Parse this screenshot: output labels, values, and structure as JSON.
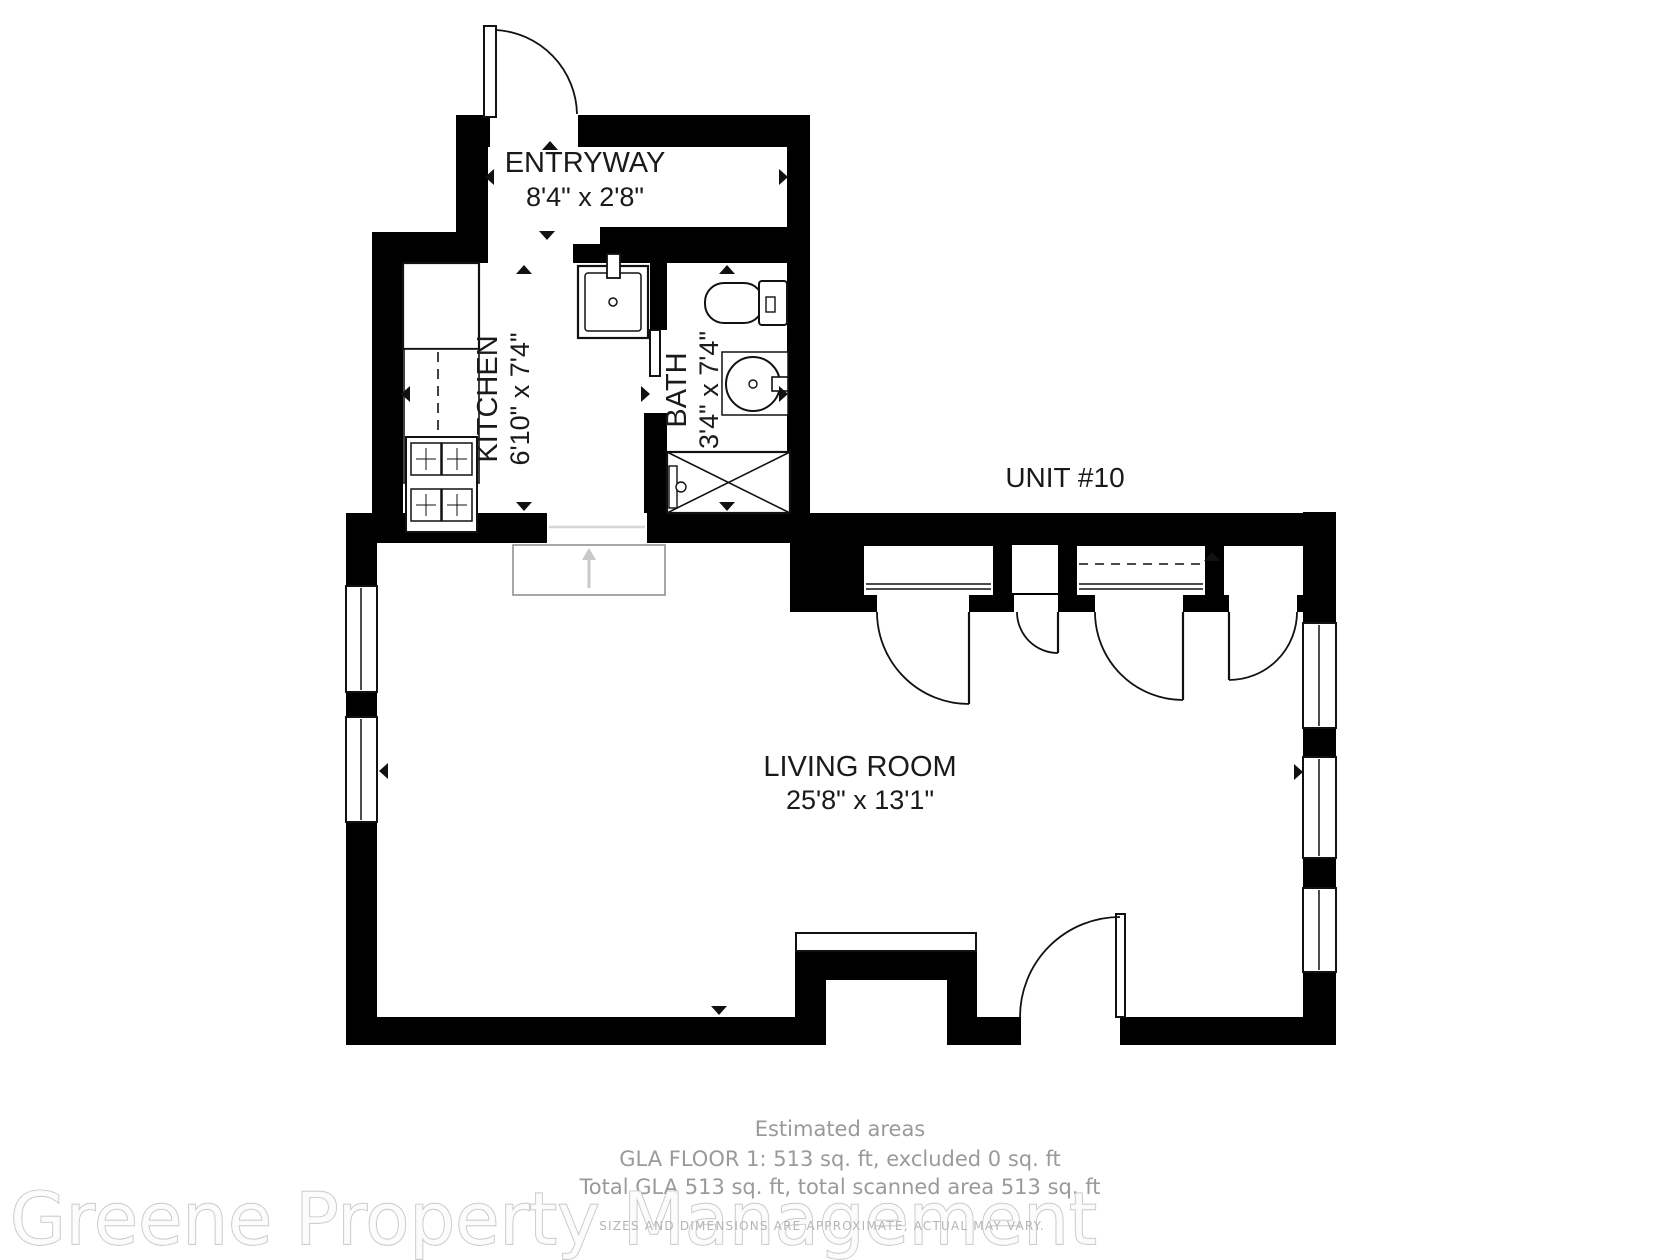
{
  "unit": {
    "label": "UNIT #10"
  },
  "rooms": {
    "entryway": {
      "name": "ENTRYWAY",
      "dimensions": "8'4\" x 2'8\""
    },
    "kitchen": {
      "name": "KITCHEN",
      "dimensions": "6'10\" x 7'4\""
    },
    "bath": {
      "name": "BATH",
      "dimensions": "3'4\" x 7'4\""
    },
    "living_room": {
      "name": "LIVING ROOM",
      "dimensions": "25'8\" x 13'1\""
    }
  },
  "footer": {
    "estimated_areas_title": "Estimated areas",
    "gla_floor_line": "GLA FLOOR 1: 513 sq. ft, excluded 0 sq. ft",
    "total_gla_line": "Total GLA 513 sq. ft, total scanned area 513 sq. ft",
    "disclaimer": "SIZES AND DIMENSIONS ARE APPROXIMATE, ACTUAL MAY VARY.",
    "watermark": "Greene Property Management"
  },
  "colors": {
    "wall": "#000000",
    "label_text": "#1a1a1a",
    "footer_text": "#9a9a9a",
    "disclaimer_text": "#b5b5b5",
    "watermark_outline": "#bfbfbf",
    "scan_accent": "#c8c8c8",
    "background": "#ffffff"
  }
}
